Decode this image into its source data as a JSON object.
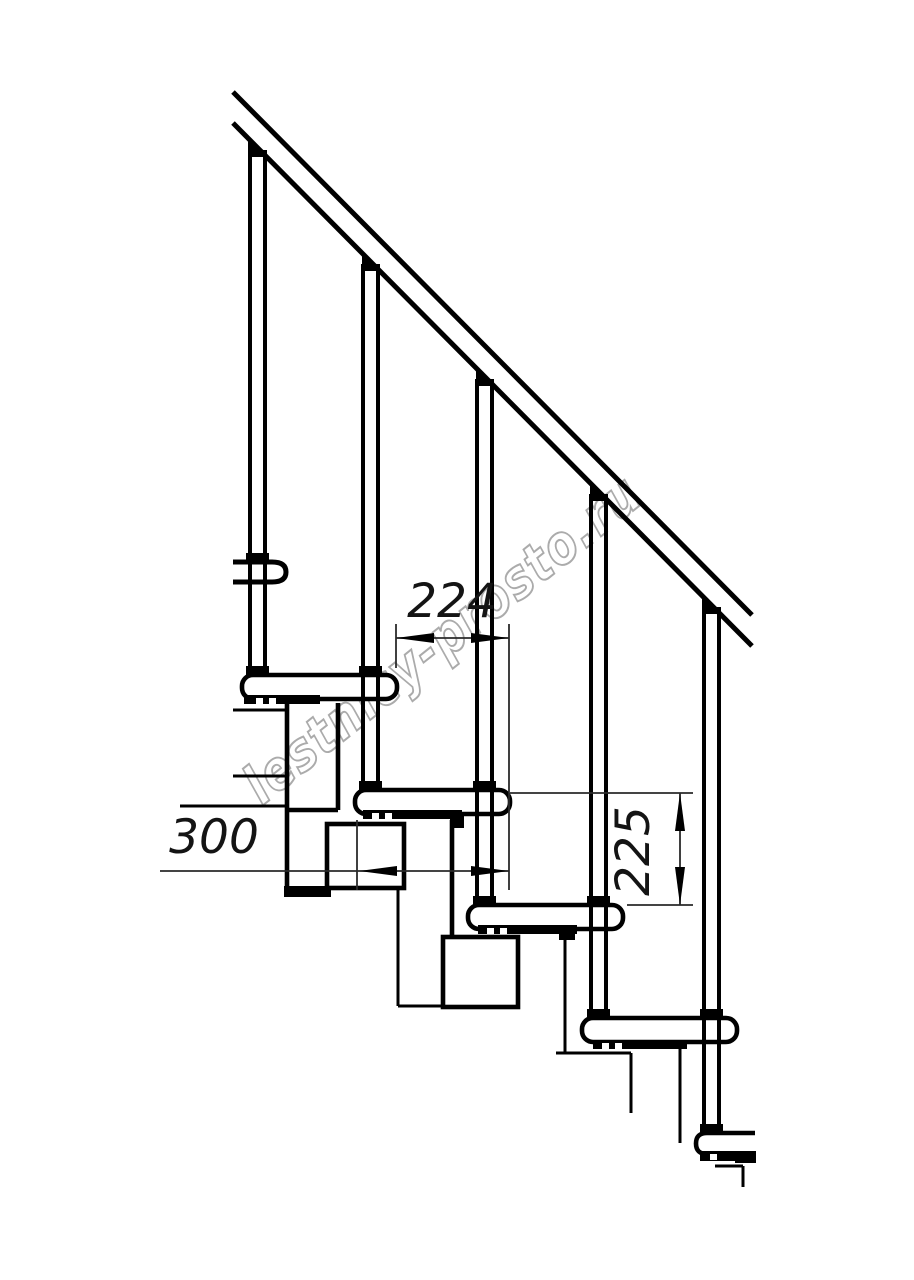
{
  "title": "Modular staircase side-view technical drawing",
  "dimensions": {
    "run_label": "224",
    "depth_label": "300",
    "rise_label": "225"
  },
  "watermark": {
    "text": "lestnicy-prosto.ru",
    "color": "#ababab"
  },
  "structure": {
    "balusters": 5,
    "treads": 5,
    "handrail_lines": 2
  },
  "colors": {
    "line": "#000000",
    "background": "#ffffff",
    "dimension_text": "#141414",
    "watermark": "#ababab"
  }
}
